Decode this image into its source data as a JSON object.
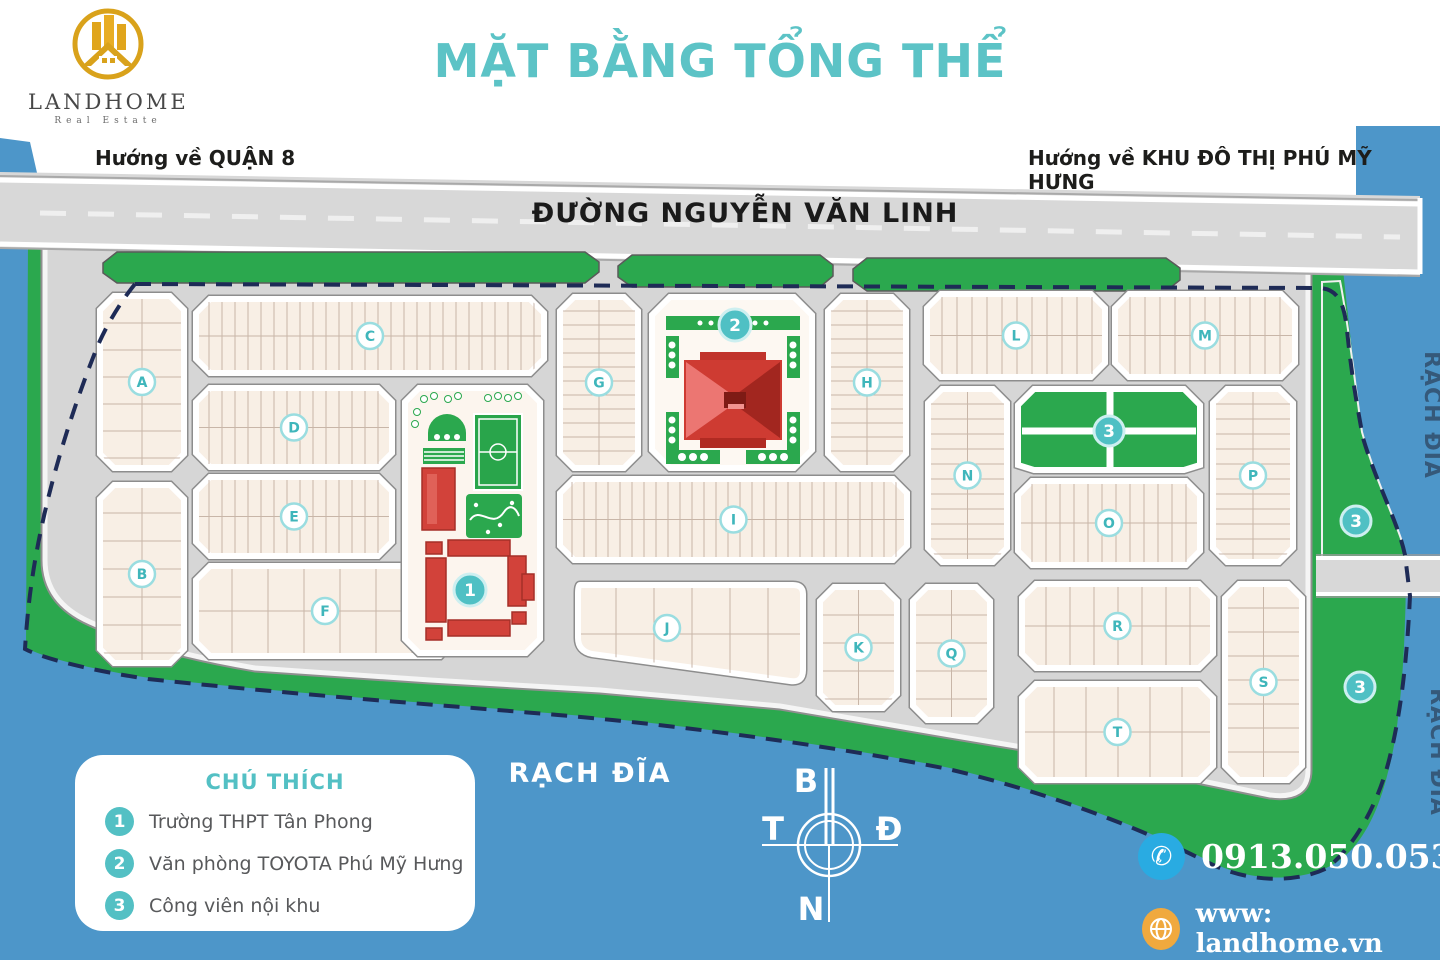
{
  "header": {
    "brand": {
      "name": "LANDHOME",
      "tagline": "Real Estate"
    },
    "title": "MẶT BẰNG TỔNG THỂ",
    "direction_left": "Hướng về QUẬN 8",
    "direction_right": "Hướng về KHU ĐÔ THỊ PHÚ MỸ HƯNG"
  },
  "map": {
    "main_road": "ĐƯỜNG NGUYỄN VĂN LINH",
    "canal_label": "RẠCH ĐĨA",
    "blocks": [
      {
        "label": "A"
      },
      {
        "label": "B"
      },
      {
        "label": "C"
      },
      {
        "label": "D"
      },
      {
        "label": "E"
      },
      {
        "label": "F"
      },
      {
        "label": "G"
      },
      {
        "label": "H"
      },
      {
        "label": "I"
      },
      {
        "label": "J"
      },
      {
        "label": "K"
      },
      {
        "label": "L"
      },
      {
        "label": "M"
      },
      {
        "label": "N"
      },
      {
        "label": "O"
      },
      {
        "label": "P"
      },
      {
        "label": "Q"
      },
      {
        "label": "R"
      },
      {
        "label": "S"
      },
      {
        "label": "T"
      }
    ],
    "landmarks": [
      {
        "num": "1",
        "name": "Trường THPT Tân Phong"
      },
      {
        "num": "2",
        "name": "Văn phòng TOYOTA Phú Mỹ Hưng"
      },
      {
        "num": "3",
        "name": "Công viên nội khu"
      }
    ],
    "compass": {
      "north": "B",
      "east": "Đ",
      "west": "T",
      "south": "N"
    }
  },
  "legend": {
    "title": "CHÚ THÍCH",
    "items": [
      {
        "num": "1",
        "label": "Trường THPT Tân Phong"
      },
      {
        "num": "2",
        "label": "Văn phòng TOYOTA Phú Mỹ Hưng"
      },
      {
        "num": "3",
        "label": "Công viên nội khu"
      }
    ]
  },
  "contact": {
    "phone": "0913.050.053",
    "website": "www: landhome.vn"
  },
  "colors": {
    "teal": "#5cc3c6",
    "water": "#4d96c9",
    "green": "#2ba84e",
    "road_gray": "#d8d8d8",
    "block_cream": "#f8efe5",
    "landmark_red": "#ce3b32",
    "boundary_navy": "#1e2b56"
  }
}
